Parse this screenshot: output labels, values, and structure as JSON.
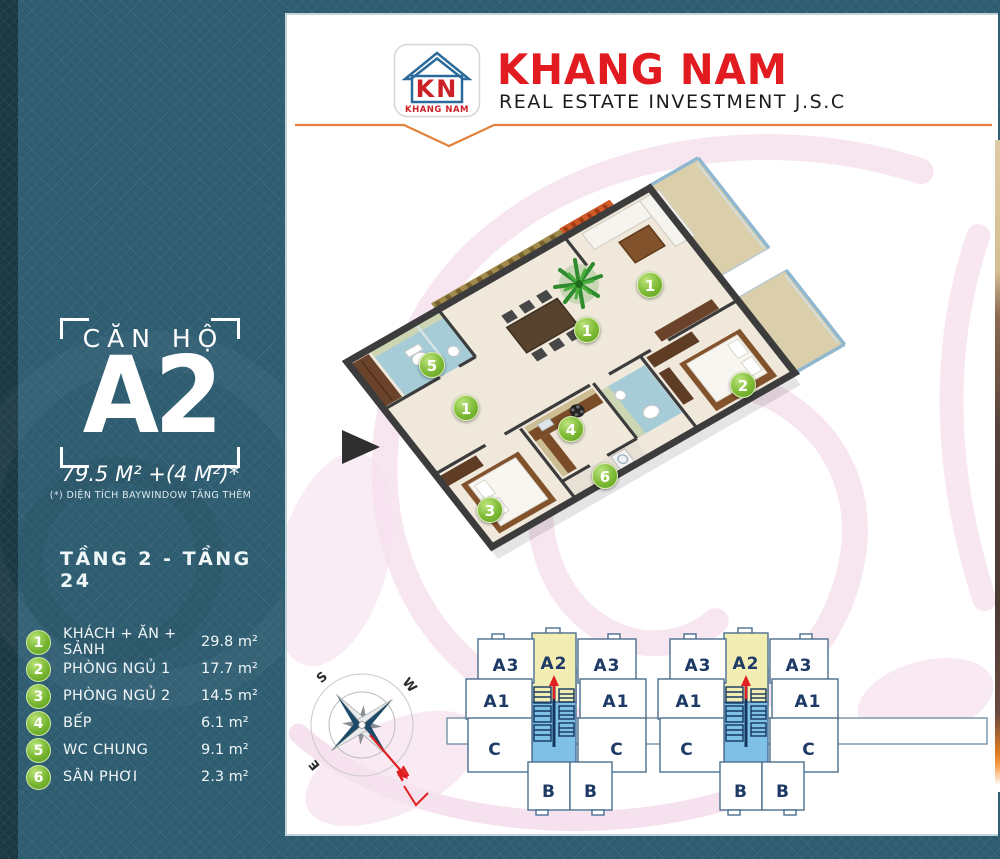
{
  "header": {
    "logo": {
      "monogram": "KN",
      "name": "KHANG NAM"
    },
    "brand": "KHANG NAM",
    "subtitle": "REAL ESTATE INVESTMENT J.S.C"
  },
  "sidebar": {
    "unit_label": "CĂN HỘ",
    "unit_code": "A2",
    "area": "79.5 M² +(4 M²)*",
    "area_note": "(*) DIỆN TÍCH BAYWINDOW TĂNG THÊM",
    "floors": "TẦNG 2 - TẦNG 24",
    "legend": [
      {
        "num": "1",
        "label": "KHÁCH + ĂN + SẢNH",
        "area": "29.8 m²"
      },
      {
        "num": "2",
        "label": "PHÒNG NGỦ 1",
        "area": "17.7 m²"
      },
      {
        "num": "3",
        "label": "PHÒNG NGỦ 2",
        "area": "14.5 m²"
      },
      {
        "num": "4",
        "label": "BẾP",
        "area": "6.1 m²"
      },
      {
        "num": "5",
        "label": "WC CHUNG",
        "area": "9.1 m²"
      },
      {
        "num": "6",
        "label": "SÂN PHƠI",
        "area": "2.3 m²"
      }
    ]
  },
  "plan": {
    "badges": [
      {
        "num": "1",
        "x": 648,
        "y": 283
      },
      {
        "num": "1",
        "x": 585,
        "y": 328
      },
      {
        "num": "5",
        "x": 430,
        "y": 363
      },
      {
        "num": "1",
        "x": 464,
        "y": 406
      },
      {
        "num": "4",
        "x": 569,
        "y": 427
      },
      {
        "num": "2",
        "x": 741,
        "y": 383
      },
      {
        "num": "6",
        "x": 603,
        "y": 474
      },
      {
        "num": "3",
        "x": 488,
        "y": 508
      }
    ]
  },
  "compass": {
    "n": "N",
    "s": "S",
    "e": "E",
    "w": "W"
  },
  "key_plan": {
    "labels": {
      "a3_left": "A3",
      "a2": "A2",
      "a3_right": "A3",
      "a1_left": "A1",
      "a1_right": "A1",
      "c_left": "C",
      "c_right": "C",
      "b_left": "B",
      "b_right": "B"
    }
  },
  "colors": {
    "accent_line": "#e2823a",
    "brand_red": "#e11b1f",
    "badge_green": "#7ab832",
    "panel_teal": "#2e5d71",
    "keyplan_highlight": "#f2edb3",
    "keyplan_core": "#7fc0e6",
    "arrow_red": "#e02020"
  }
}
